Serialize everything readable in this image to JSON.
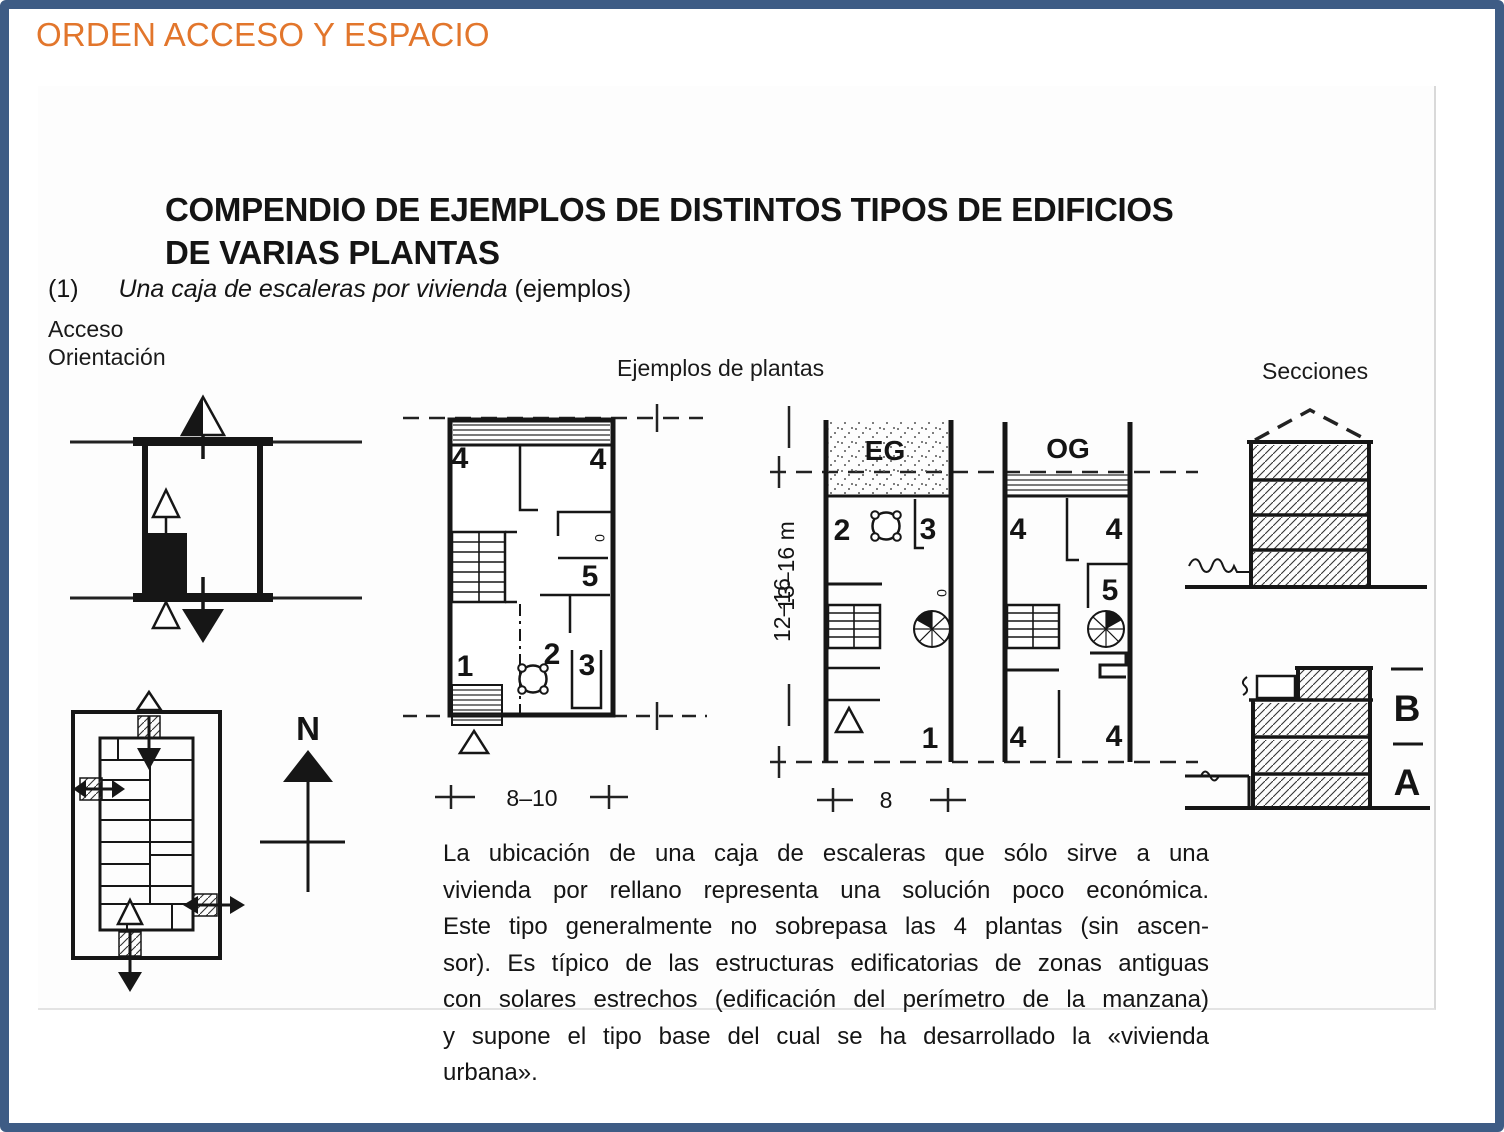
{
  "slide": {
    "title": "ORDEN ACCESO Y ESPACIO",
    "accent_color": "#e2762c",
    "border_color": "#3e5c85"
  },
  "figure": {
    "heading": {
      "line1": "COMPENDIO DE EJEMPLOS DE DISTINTOS TIPOS DE EDIFICIOS",
      "line2": "DE VARIAS PLANTAS"
    },
    "item": {
      "number": "(1)",
      "title_italic": "Una caja de escaleras por vivienda",
      "suffix": "(ejemplos)"
    },
    "labels": {
      "acceso": "Acceso",
      "orientacion": "Orientación",
      "ejemplos_plantas": "Ejemplos de plantas",
      "secciones": "Secciones",
      "north": "N"
    },
    "plan_middle": {
      "room4a": "4",
      "room4b": "4",
      "room5": "5",
      "room1": "1",
      "room2": "2",
      "room3": "3",
      "door": "0",
      "height_dim": "13–16 m",
      "width_dim": "8–10"
    },
    "plan_eg": {
      "label": "EG",
      "room2": "2",
      "room3": "3",
      "room1": "1",
      "door": "0",
      "height_dim": "12–16",
      "width_dim": "8"
    },
    "plan_og": {
      "label": "OG",
      "room4a": "4",
      "room4b": "4",
      "room5": "5",
      "room4c": "4",
      "room4d": "4"
    },
    "sections": {
      "b_label": "B",
      "a_label": "A"
    },
    "paragraph": {
      "lines": [
        "La ubicación de una caja de escaleras que sólo sirve a una",
        "vivienda por rellano representa una solución poco económica.",
        "Este tipo generalmente no sobrepasa las 4 plantas (sin ascen-",
        "sor). Es típico de las estructuras edificatorias de zonas antiguas",
        "con solares estrechos (edificación del perímetro de la manzana)",
        "y supone el tipo base del cual se ha desarrollado la «vivienda",
        "urbana»."
      ]
    }
  }
}
